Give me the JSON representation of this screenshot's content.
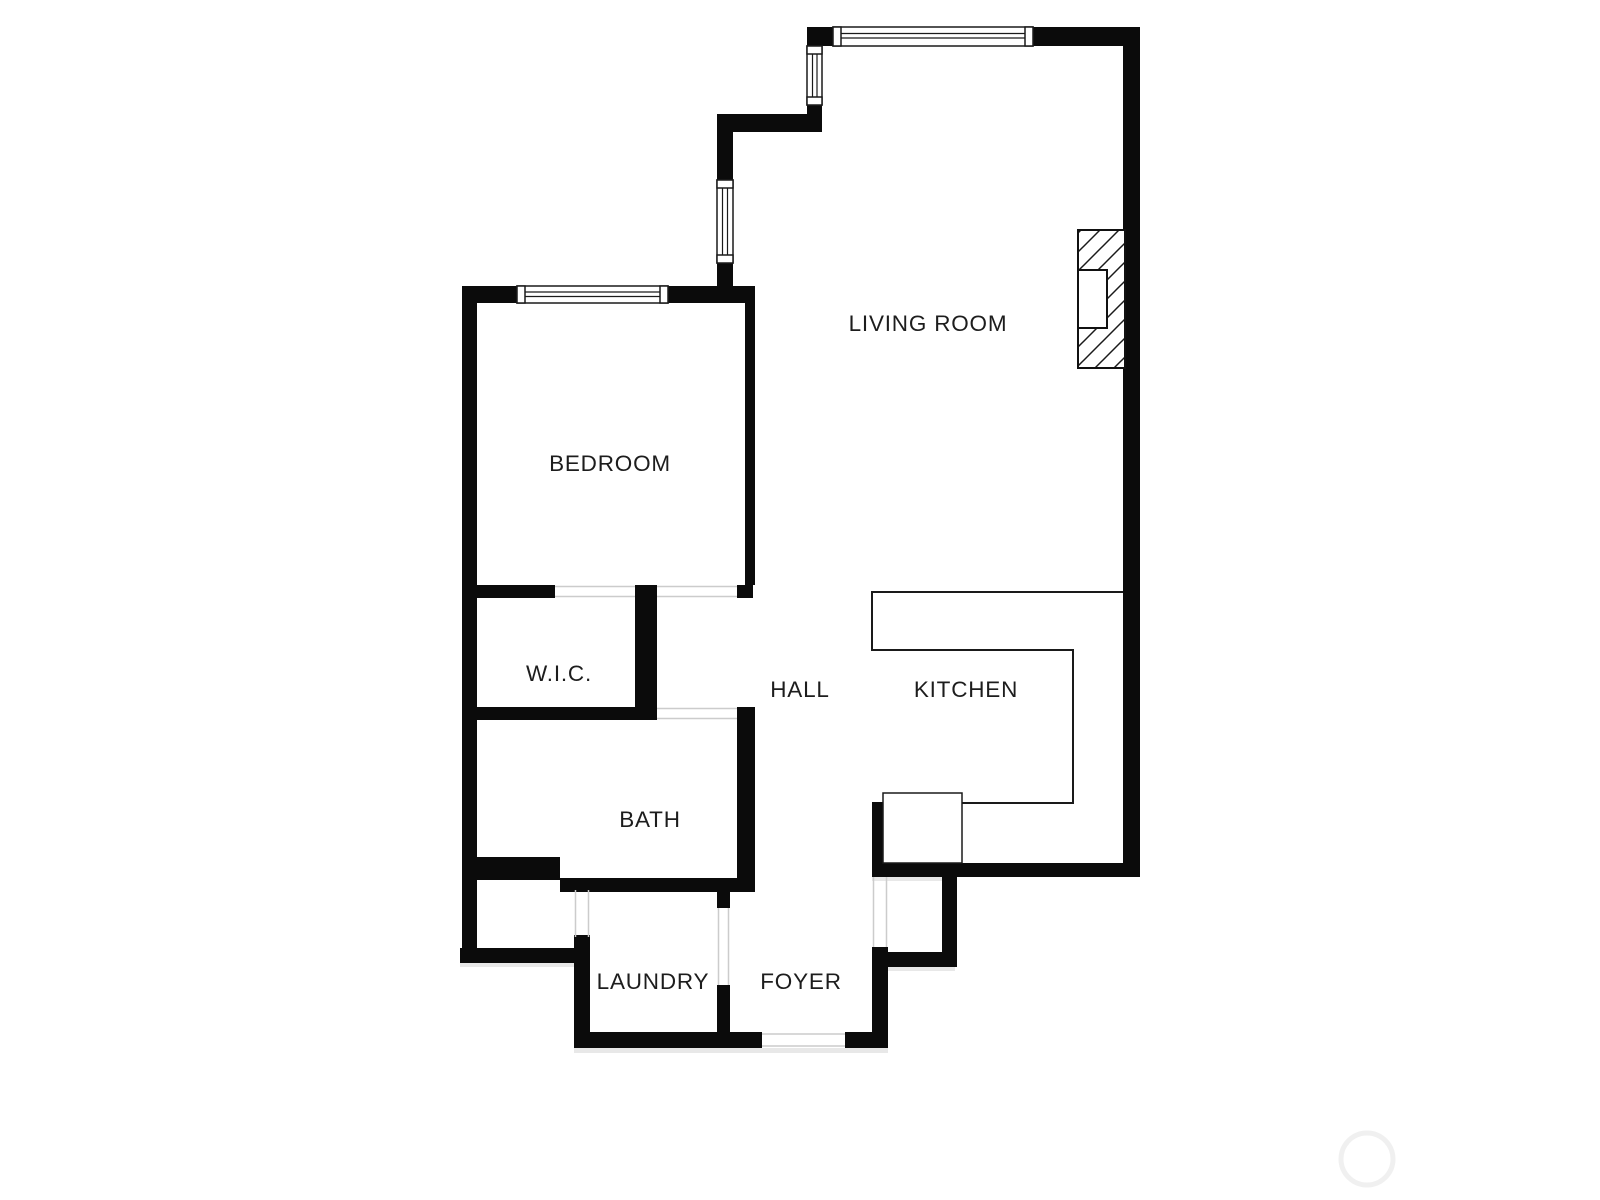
{
  "plan": {
    "rooms": {
      "living_room": {
        "label": "LIVING ROOM"
      },
      "bedroom": {
        "label": "BEDROOM"
      },
      "wic": {
        "label": "W.I.C."
      },
      "hall": {
        "label": "HALL"
      },
      "kitchen": {
        "label": "KITCHEN"
      },
      "bath": {
        "label": "BATH"
      },
      "laundry": {
        "label": "LAUNDRY"
      },
      "foyer": {
        "label": "FOYER"
      }
    },
    "colors": {
      "background": "#ffffff",
      "wall": "#0b0b0b",
      "thin_line": "#1a1a1a",
      "door_jamb": "#cccccc",
      "label_text": "#1d1d1d",
      "watermark_circle": "#f0f0f0"
    },
    "symbols": {
      "fireplace": "hatched fireplace with firebox",
      "windows": "double-line windows with end frames",
      "kitchen_counter": "thin-line U counter with appliance box",
      "watermark": "faint circle, bottom right"
    }
  }
}
